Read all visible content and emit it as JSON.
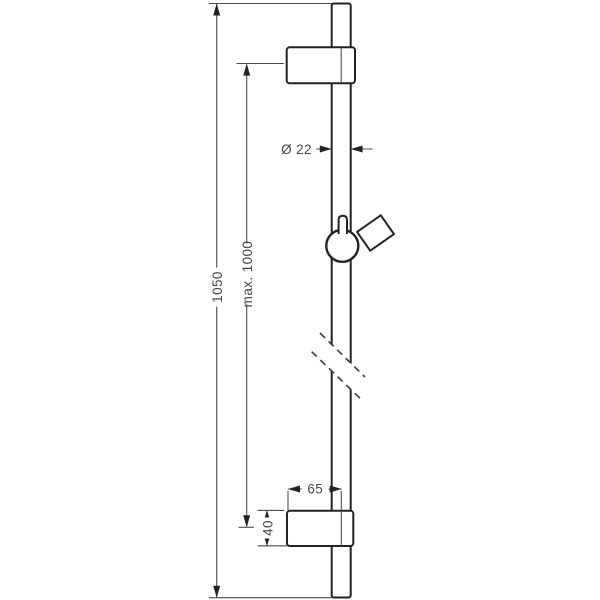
{
  "drawing": {
    "colors": {
      "background": "#ffffff",
      "outline": "#232323",
      "dimension_lines": "#4d4d4d",
      "text": "#474747"
    },
    "dimensions": {
      "total_length": "1050",
      "max_mounting_distance": "max. 1000",
      "bar_diameter": "Ø 22",
      "wall_offset": "65",
      "bracket_height": "40"
    }
  }
}
